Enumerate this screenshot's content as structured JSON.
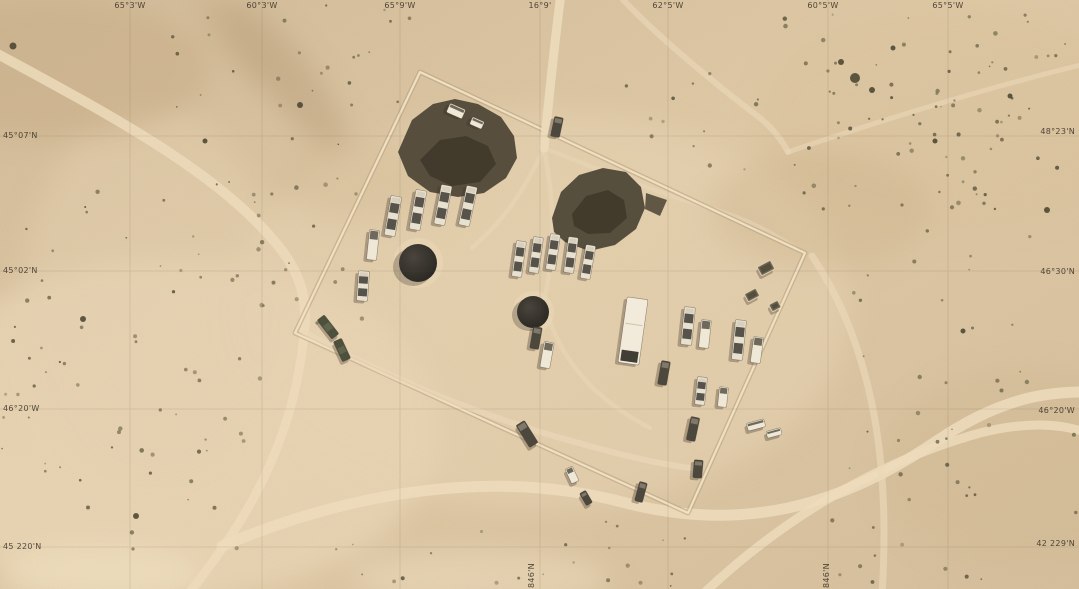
{
  "graticule": {
    "top": [
      "65°3'W",
      "60°3'W",
      "65°9'W",
      "16°9'",
      "62°5'W",
      "60°5'W",
      "65°5'W"
    ],
    "left": [
      "45°07'N",
      "45°02'N",
      "46°20'W",
      "45 220'N"
    ],
    "right": [
      "48°23'N",
      "46°30'N",
      "46°20'W",
      "42 229'N"
    ],
    "bottom": [
      "846'N",
      "846'N"
    ]
  },
  "colors": {
    "sand_base": "#dcc5a2",
    "sand_light": "#ecd9b8",
    "road": "#ecdbbb",
    "berm": "#b49c79",
    "camouflage_net": "#4b4334",
    "radar_dome": "#2e2b25",
    "vehicle_light": "#efe8d7",
    "vehicle_dark": "#4d483e",
    "vehicle_green": "#4d503d",
    "label_text": "#30291f"
  },
  "features": [
    "desert-terrain",
    "dirt-road-network",
    "bermed-compound",
    "camouflage-netting",
    "vehicle-convoy-clusters",
    "radar-dome-pads",
    "desert-shrubs",
    "coordinate-graticule"
  ]
}
